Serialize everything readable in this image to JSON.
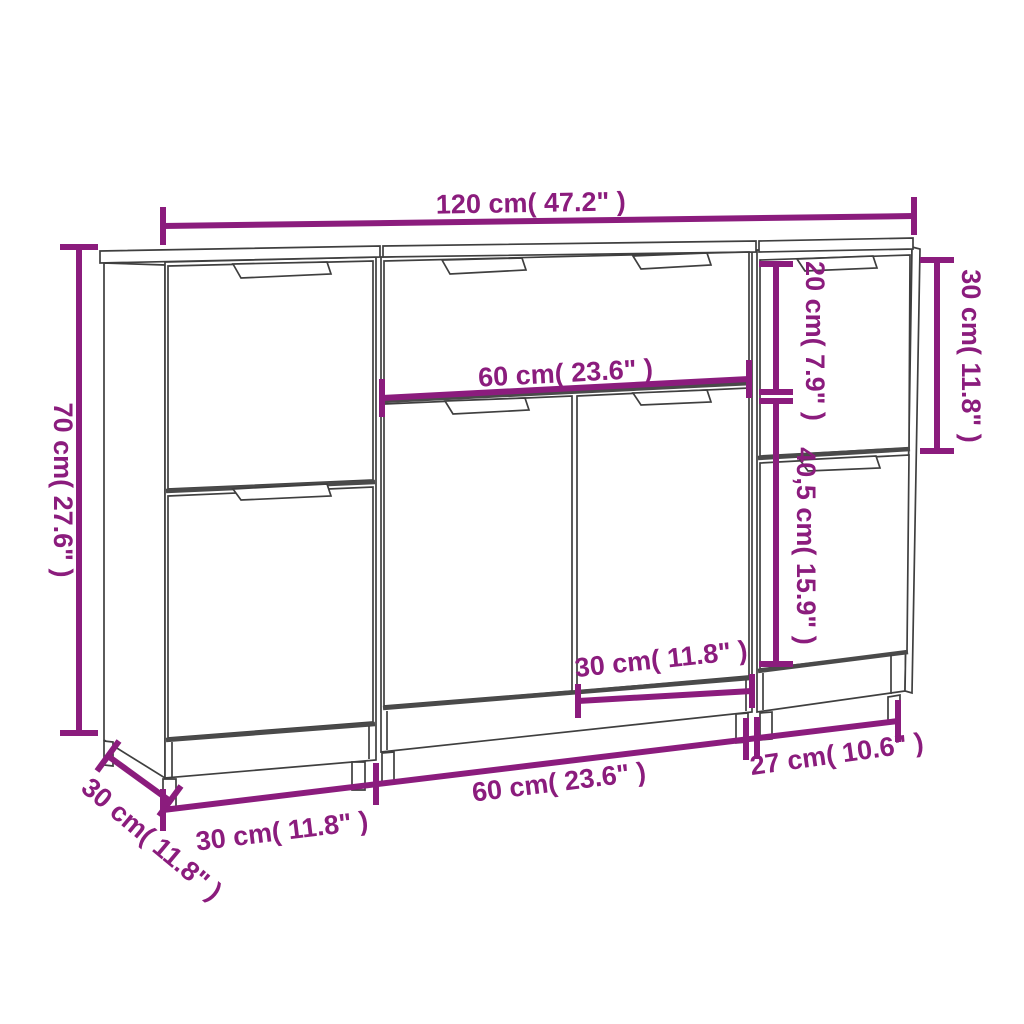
{
  "meta": {
    "background": "#FFFFFF",
    "accent_color": "#8B1C7D",
    "line_color": "#3F3F3F",
    "shadow_line_color": "#4A4A4A",
    "drawing": "three-piece sideboard dimension diagram"
  },
  "dimensions": {
    "overall_width": "120 cm( 47.2\" )",
    "overall_height": "70 cm( 27.6\" )",
    "depth": "30 cm( 11.8\" )",
    "middle_section_width": "60 cm( 23.6\" )",
    "middle_right_door_width": "30 cm( 11.8\" )",
    "right_drawer_height": "20 cm( 7.9\" )",
    "right_upper_door_height": "30 cm( 11.8\" )",
    "right_lower_section_height": "40,5 cm( 15.9\" )",
    "bottom_left_unit_width": "30 cm( 11.8\" )",
    "bottom_middle_unit_width": "60 cm( 23.6\" )",
    "bottom_right_unit_width": "27 cm( 10.6\" )"
  }
}
